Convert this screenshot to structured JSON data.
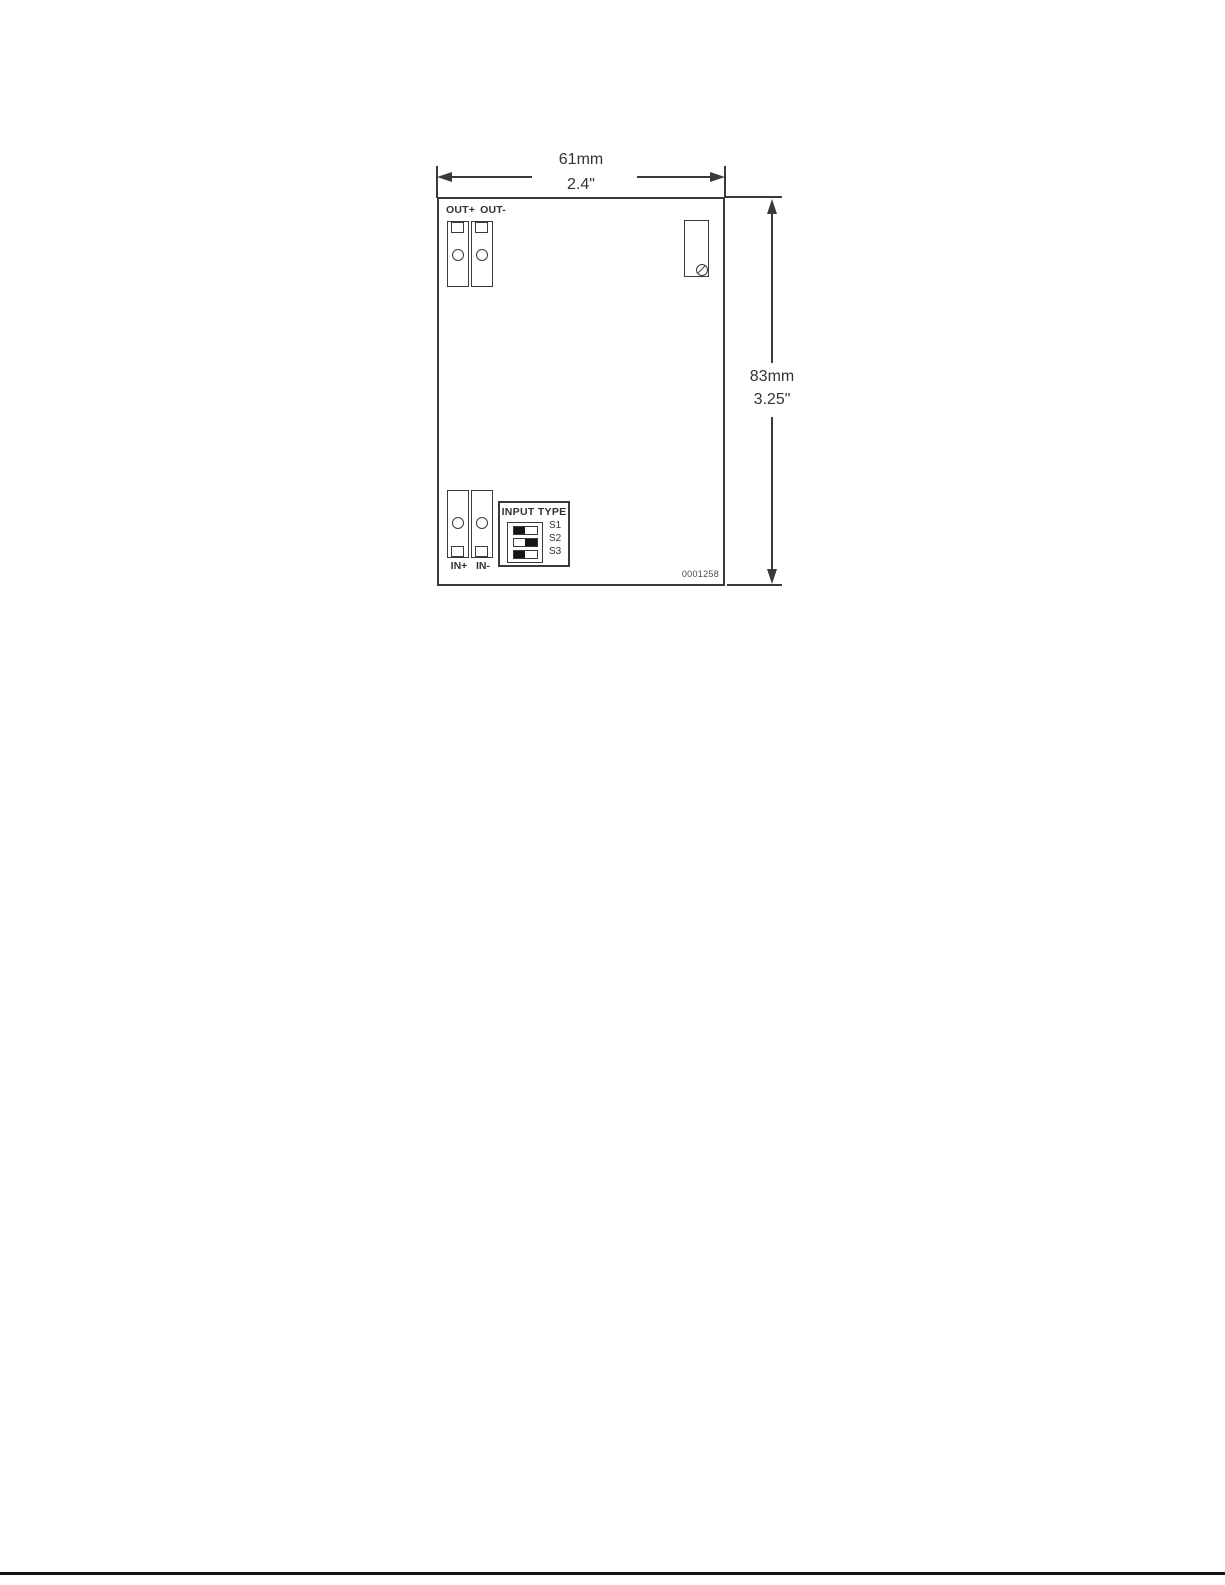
{
  "dimensions": {
    "width_mm": "61mm",
    "width_in": "2.4\"",
    "height_mm": "83mm",
    "height_in": "3.25\""
  },
  "panel": {
    "out_terminal": {
      "label_plus": "OUT+",
      "label_minus": "OUT-"
    },
    "in_terminal": {
      "label_plus": "IN+",
      "label_minus": "IN-"
    },
    "dip": {
      "title": "INPUT TYPE",
      "switches": [
        {
          "label": "S1",
          "on_side": "left"
        },
        {
          "label": "S2",
          "on_side": "right"
        },
        {
          "label": "S3",
          "on_side": "left"
        }
      ]
    },
    "part_number": "0001258"
  },
  "colors": {
    "line": "#3a3a3a",
    "text": "#333333",
    "switch_on": "#161616",
    "part_number": "#4a4a4a",
    "footer_rule": "#141414",
    "background": "#ffffff"
  }
}
